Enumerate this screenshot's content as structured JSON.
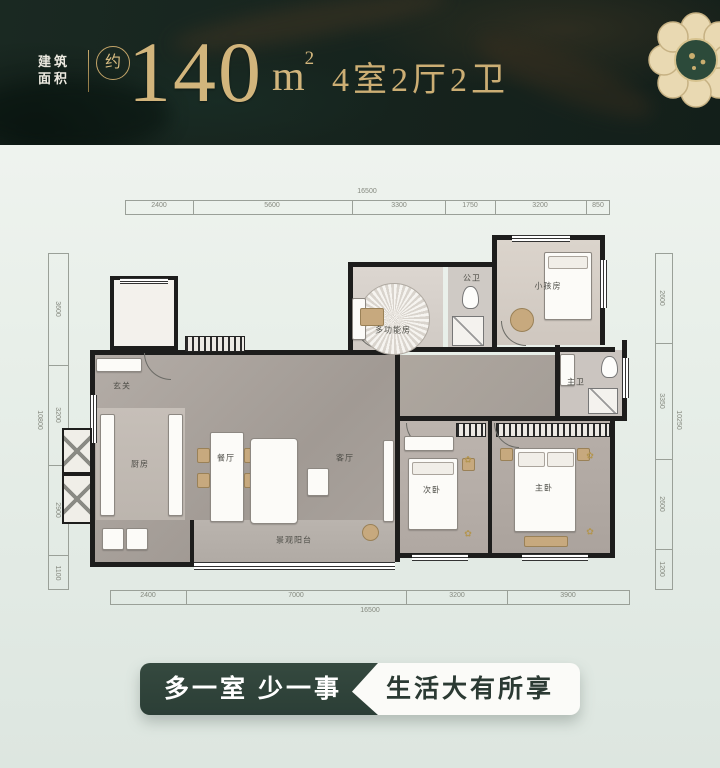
{
  "header": {
    "area_label_line1": "建筑",
    "area_label_line2": "面积",
    "approx": "约",
    "area_value": "140",
    "area_unit": "m",
    "area_unit_sup": "2",
    "layout": "4室2厅2卫"
  },
  "floorplan": {
    "dims": {
      "top": {
        "total": "16500",
        "segments": [
          "2400",
          "5600",
          "3300",
          "1750",
          "3200",
          "850"
        ]
      },
      "bottom": {
        "total": "16500",
        "segments": [
          "2400",
          "7000",
          "3200",
          "3900"
        ]
      },
      "left": {
        "total": "10800",
        "segments": [
          "3600",
          "3200",
          "2900",
          "1100"
        ]
      },
      "right": {
        "total": "10250",
        "segments": [
          "2600",
          "3350",
          "2600",
          "1200"
        ]
      }
    },
    "rooms": {
      "entry": "玄关",
      "kitchen": "厨房",
      "dining": "餐厅",
      "living": "客厅",
      "balcony": "景观阳台",
      "multi": "多功能房",
      "guest_bath": "公卫",
      "kids": "小孩房",
      "second_bedroom": "次卧",
      "master_bedroom": "主卧",
      "master_bath": "主卫"
    }
  },
  "banner": {
    "left": "多一室 少一事",
    "right": "生活大有所享"
  },
  "colors": {
    "header_bg": "#17241e",
    "gold": "#d2b57c",
    "banner_green": "#2e423a",
    "wall": "#1d1d1c",
    "page_bg": "#e8efe9"
  }
}
